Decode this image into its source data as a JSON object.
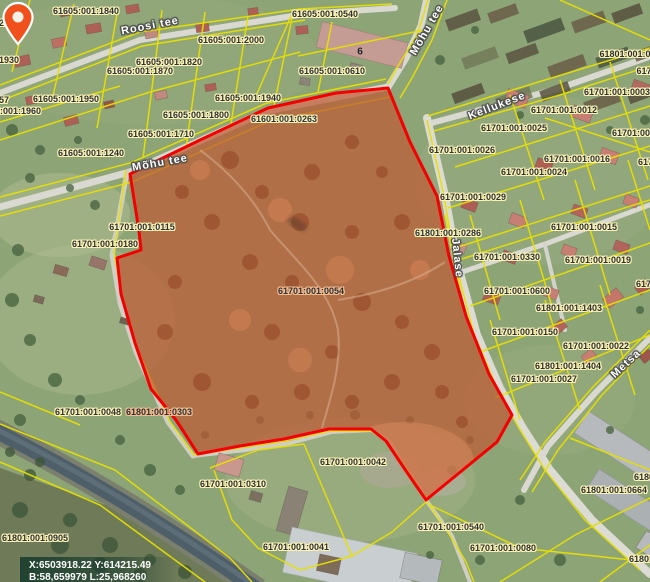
{
  "app": {
    "type": "cadastral-map-viewer"
  },
  "map": {
    "selected_parcel_code": "61701:001:0054",
    "coordinates_readout": {
      "line1": "X:6503918.22 Y:614215.49",
      "line2": "B:58,659979 L:25,968260"
    },
    "colors": {
      "cadastral_line": "#e8e000",
      "selection_outline": "#f40000",
      "selection_fill": "#bf5a34",
      "marker": "#f0511c",
      "label_text": "#2a3038",
      "label_halo": "#fdf3b4",
      "road_label_text": "#ffffff",
      "water": "#4e5f69"
    },
    "parcel_labels": [
      {
        "text": "61605:001:1840",
        "x": 86,
        "y": 11
      },
      {
        "text": "61605:001:0540",
        "x": 325,
        "y": 14
      },
      {
        "text": "61605:001:2000",
        "x": 231,
        "y": 40
      },
      {
        "text": "61605:001:1820",
        "x": 169,
        "y": 62
      },
      {
        "text": "61605:001:1870",
        "x": 140,
        "y": 71
      },
      {
        "text": "61605:001:0610",
        "x": 332,
        "y": 71
      },
      {
        "text": "61605:001:1930",
        "x": -14,
        "y": 60
      },
      {
        "text": "61605:001:1950",
        "x": 66,
        "y": 99
      },
      {
        "text": "61605:001:1960",
        "x": 8,
        "y": 111
      },
      {
        "text": "61605:001:1800",
        "x": 196,
        "y": 115
      },
      {
        "text": "61605:001:1940",
        "x": 248,
        "y": 98
      },
      {
        "text": "61601:001:0263",
        "x": 284,
        "y": 119
      },
      {
        "text": "61605:001:1710",
        "x": 161,
        "y": 134
      },
      {
        "text": "61605:001:1240",
        "x": 91,
        "y": 153
      },
      {
        "text": "61701:001:0115",
        "x": 142,
        "y": 227
      },
      {
        "text": "61701:001:0180",
        "x": 105,
        "y": 244
      },
      {
        "text": "61701:001:0054",
        "x": 311,
        "y": 291,
        "cls": "onred"
      },
      {
        "text": "61701:001:0048",
        "x": 88,
        "y": 412
      },
      {
        "text": "61801:001:0303",
        "x": 159,
        "y": 412,
        "cls": "onred"
      },
      {
        "text": "61801:001:0905",
        "x": 35,
        "y": 538
      },
      {
        "text": "61701:001:0310",
        "x": 233,
        "y": 484
      },
      {
        "text": "61701:001:0042",
        "x": 353,
        "y": 462
      },
      {
        "text": "61701:001:0041",
        "x": 296,
        "y": 547
      },
      {
        "text": "61701:001:0540",
        "x": 451,
        "y": 527
      },
      {
        "text": "61701:001:0080",
        "x": 503,
        "y": 548
      },
      {
        "text": "61801:001:0664",
        "x": 614,
        "y": 490
      },
      {
        "text": "61701:001:0025",
        "x": 514,
        "y": 128
      },
      {
        "text": "61701:001:0026",
        "x": 462,
        "y": 150
      },
      {
        "text": "61701:001:0012",
        "x": 564,
        "y": 110
      },
      {
        "text": "61701:001:0003",
        "x": 617,
        "y": 92
      },
      {
        "text": "61701:001:0016",
        "x": 577,
        "y": 159
      },
      {
        "text": "61701:001:0024",
        "x": 534,
        "y": 172
      },
      {
        "text": "61701:001:0029",
        "x": 473,
        "y": 197
      },
      {
        "text": "61701:001:0015",
        "x": 584,
        "y": 227
      },
      {
        "text": "61801:001:0286",
        "x": 448,
        "y": 233
      },
      {
        "text": "61701:001:0330",
        "x": 507,
        "y": 257
      },
      {
        "text": "61701:001:0019",
        "x": 598,
        "y": 260
      },
      {
        "text": "61701:001:0600",
        "x": 517,
        "y": 291
      },
      {
        "text": "61801:001:1403",
        "x": 569,
        "y": 308
      },
      {
        "text": "61701:001:0150",
        "x": 525,
        "y": 332
      },
      {
        "text": "61701:001:0022",
        "x": 596,
        "y": 346
      },
      {
        "text": "61801:001:1404",
        "x": 568,
        "y": 366
      },
      {
        "text": "61701:001:0027",
        "x": 544,
        "y": 379
      },
      {
        "text": "20",
        "x": 4,
        "y": 23
      },
      {
        "text": "57",
        "x": 4,
        "y": 100
      },
      {
        "text": "61801:001:0",
        "x": 625,
        "y": 54
      },
      {
        "text": "617",
        "x": 644,
        "y": 71
      },
      {
        "text": "61701:001:00",
        "x": 640,
        "y": 133
      },
      {
        "text": "6170",
        "x": 648,
        "y": 162
      },
      {
        "text": "6170",
        "x": 646,
        "y": 284
      },
      {
        "text": "6180",
        "x": 644,
        "y": 477
      },
      {
        "text": "61801:",
        "x": 643,
        "y": 559
      },
      {
        "text": "6",
        "x": 360,
        "y": 52,
        "cls": "house"
      }
    ],
    "road_labels": [
      {
        "text": "Roosi tee",
        "x": 150,
        "y": 26,
        "rot": -11
      },
      {
        "text": "Mõhu tee",
        "x": 427,
        "y": 30,
        "rot": -60
      },
      {
        "text": "Mõhu tee",
        "x": 160,
        "y": 163,
        "rot": -10
      },
      {
        "text": "Kellukese",
        "x": 497,
        "y": 106,
        "rot": -21
      },
      {
        "text": "Jalase",
        "x": 457,
        "y": 258,
        "rot": 84
      },
      {
        "text": "Metsa",
        "x": 626,
        "y": 364,
        "rot": -43
      }
    ]
  }
}
